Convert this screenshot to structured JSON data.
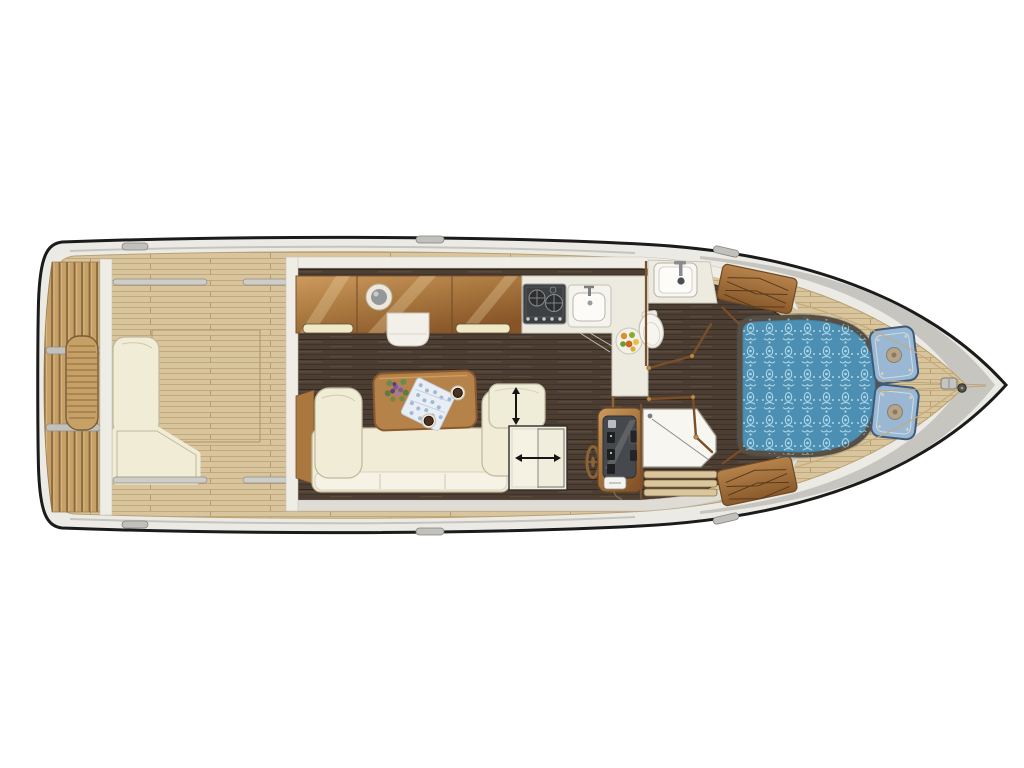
{
  "page": {
    "title": "Motor yacht deck and accommodation floor plan",
    "view": "top-down",
    "orientation": "bow-right",
    "background": "#ffffff"
  },
  "colors": {
    "hull_outline": "#1b1b1b",
    "hull_band": "#eceae4",
    "gunwale_gray": "#c7c5bf",
    "teak_deck": "#d8c59d",
    "platform_teak": "#c7a066",
    "floor_dark": "#4c3e33",
    "cabinet_wood": "#a9783f",
    "trim_brown": "#7a4f28",
    "upholstery_cream": "#f0ecd6",
    "counter_white": "#edebdf",
    "table_wood": "#b5824a",
    "bed_blue": "#4d8fb2",
    "bed_pattern": "#b8e0ee",
    "pillow_blue": "#9ab8d4",
    "shower_white": "#f7f6f1",
    "dashboard_gray": "#45484c"
  },
  "regions": {
    "swim_platform": {
      "name": "swim platform",
      "items": [
        "teak slats",
        "transom seat"
      ]
    },
    "cockpit": {
      "name": "aft cockpit",
      "items": [
        "L-shaped bench",
        "grab rails",
        "deck hatch"
      ]
    },
    "salon": {
      "name": "salon and galley",
      "items": [
        "overhead cabinets",
        "porthole",
        "two-burner stove",
        "galley sink",
        "L-shaped counter",
        "fruit bowl",
        "sofa",
        "coffee table",
        "flower bouquet",
        "blue cloth",
        "two cups",
        "sliding backrest",
        "sliding door",
        "helm console",
        "steering wheel"
      ]
    },
    "head": {
      "name": "head compartment",
      "items": [
        "washbasin",
        "faucet",
        "toilet",
        "folding doors"
      ]
    },
    "shower": {
      "name": "shower compartment",
      "items": [
        "shower tray",
        "teak grate"
      ]
    },
    "forward_cabin": {
      "name": "forward cabin",
      "items": [
        "double bed with damask spread",
        "two pillows",
        "louvered lockers"
      ]
    },
    "foredeck": {
      "name": "foredeck",
      "items": [
        "teak planking",
        "anchor windlass",
        "mooring cleats"
      ]
    }
  },
  "annotations": [
    {
      "name": "sliding-backrest-arrow",
      "icon": "arrow-up-down",
      "glyph": "vertical double arrow"
    },
    {
      "name": "sliding-door-arrow",
      "icon": "arrow-left-right",
      "glyph": "horizontal double arrow"
    }
  ]
}
